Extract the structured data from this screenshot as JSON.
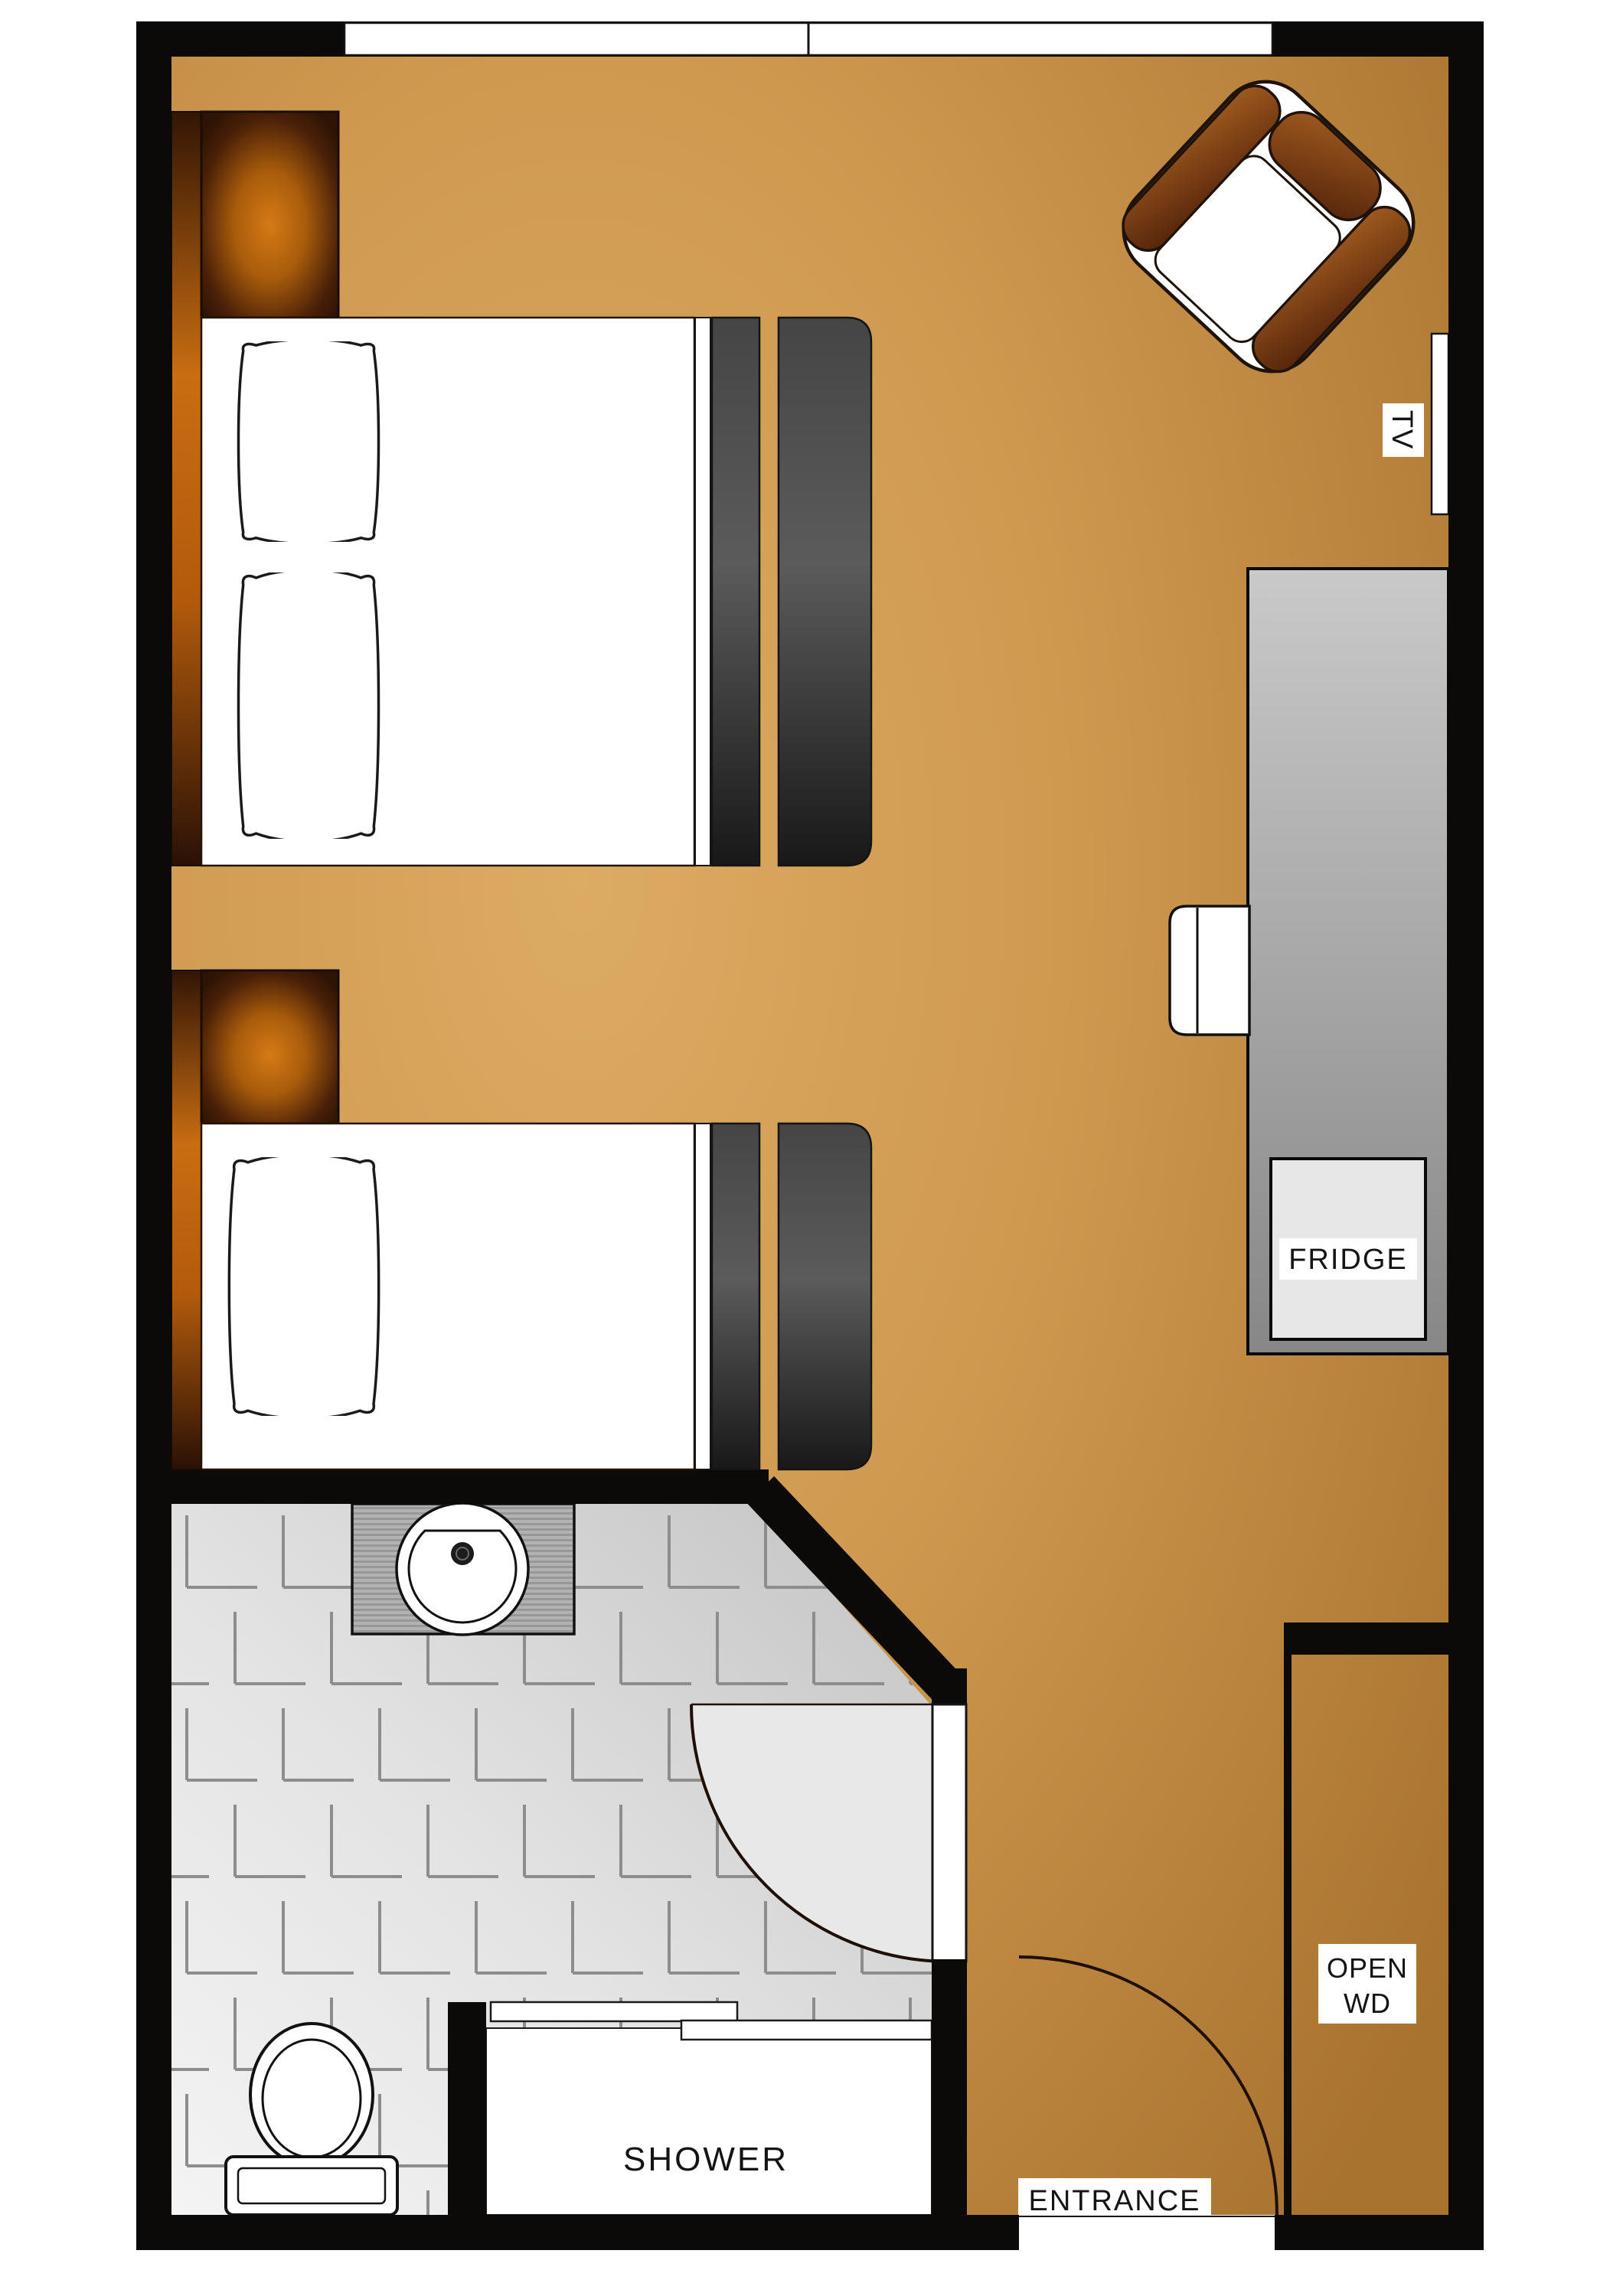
{
  "plan": {
    "type": "hotel-room-floor-plan",
    "labels": {
      "tv": "TV",
      "fridge": "FRIDGE",
      "shower": "SHOWER",
      "entrance": "ENTRANCE",
      "open_wardrobe": {
        "line1": "OPEN",
        "line2": "WD"
      }
    },
    "colors": {
      "wall": "#0c0a08",
      "floor_light": "#dcab64",
      "floor_mid": "#cf9950",
      "floor_dark": "#a8732f",
      "tile_light": "#f2f2f2",
      "tile_dark": "#c3c3c3",
      "tile_mark": "#8d8d8d",
      "lamp_glow": "#d57a16",
      "lamp_base": "#2e1405",
      "headboard_orange": "#c96d12",
      "cushion_light": "#a25b1f",
      "cushion_dark": "#52230a",
      "blanket_light": "#5b5b5b",
      "blanket_dark": "#181818",
      "counter_light": "#c9c9c9",
      "counter_dark": "#878787",
      "fridge_box": "#e7e7e7",
      "door_swing_fill": "#e8e8e8"
    }
  }
}
